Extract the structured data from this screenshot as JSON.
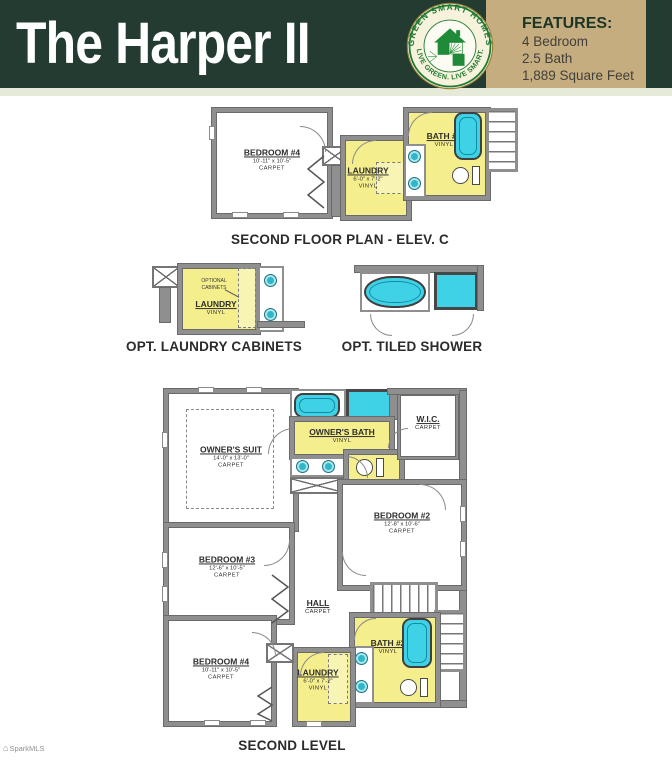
{
  "header": {
    "title": "The Harper II",
    "logo": {
      "arc_top": "GREEN SMART HOMES",
      "arc_bottom": "LIVE GREEN. LIVE SMART."
    },
    "features": {
      "heading": "FEATURES:",
      "items": [
        "4 Bedroom",
        "2.5 Bath",
        "1,889 Square Feet"
      ]
    }
  },
  "colors": {
    "header_green": "#233B31",
    "panel_tan": "#C6AD80",
    "logo_green": "#1E7A33",
    "room_yellow": "#F5EE8D",
    "fixture_cyan": "#3FD2E6",
    "sink_teal": "#2FB7C9"
  },
  "plans": {
    "elev_c": {
      "caption": "SECOND FLOOR PLAN - ELEV. C",
      "rooms": {
        "bedroom4": {
          "name": "BEDROOM #4",
          "dims": "10'-11\" x 10'-5\"",
          "floor": "CARPET"
        },
        "laundry": {
          "name": "LAUNDRY",
          "dims": "6'-0\" x 7'-2\"",
          "floor": "VINYL"
        },
        "bath2": {
          "name": "BATH #2",
          "floor": "VINYL"
        }
      }
    },
    "opt_laundry": {
      "caption": "OPT. LAUNDRY CABINETS",
      "note": "OPTIONAL CABINETS",
      "rooms": {
        "laundry": {
          "name": "LAUNDRY",
          "floor": "VINYL"
        }
      }
    },
    "opt_shower": {
      "caption": "OPT. TILED SHOWER"
    },
    "second_level": {
      "caption": "SECOND LEVEL",
      "rooms": {
        "owners_suite": {
          "name": "OWNER'S SUIT",
          "dims": "14'-0\" x 13'-0\"",
          "floor": "CARPET"
        },
        "owners_bath": {
          "name": "OWNER'S BATH",
          "floor": "VINYL"
        },
        "wic": {
          "name": "W.I.C.",
          "floor": "CARPET"
        },
        "bedroom2": {
          "name": "BEDROOM #2",
          "dims": "12'-8\" x 10'-6\"",
          "floor": "CARPET"
        },
        "bedroom3": {
          "name": "BEDROOM #3",
          "dims": "12'-6\" x 10'-5\"",
          "floor": "CARPET"
        },
        "bedroom4": {
          "name": "BEDROOM #4",
          "dims": "10'-11\" x 10'-5\"",
          "floor": "CARPET"
        },
        "hall": {
          "name": "HALL",
          "floor": "CARPET"
        },
        "laundry": {
          "name": "LAUNDRY",
          "dims": "6'-0\" x 7'-2\"",
          "floor": "VINYL"
        },
        "bath2": {
          "name": "BATH #2",
          "floor": "VINYL"
        }
      }
    }
  },
  "watermark": "SparkMLS"
}
